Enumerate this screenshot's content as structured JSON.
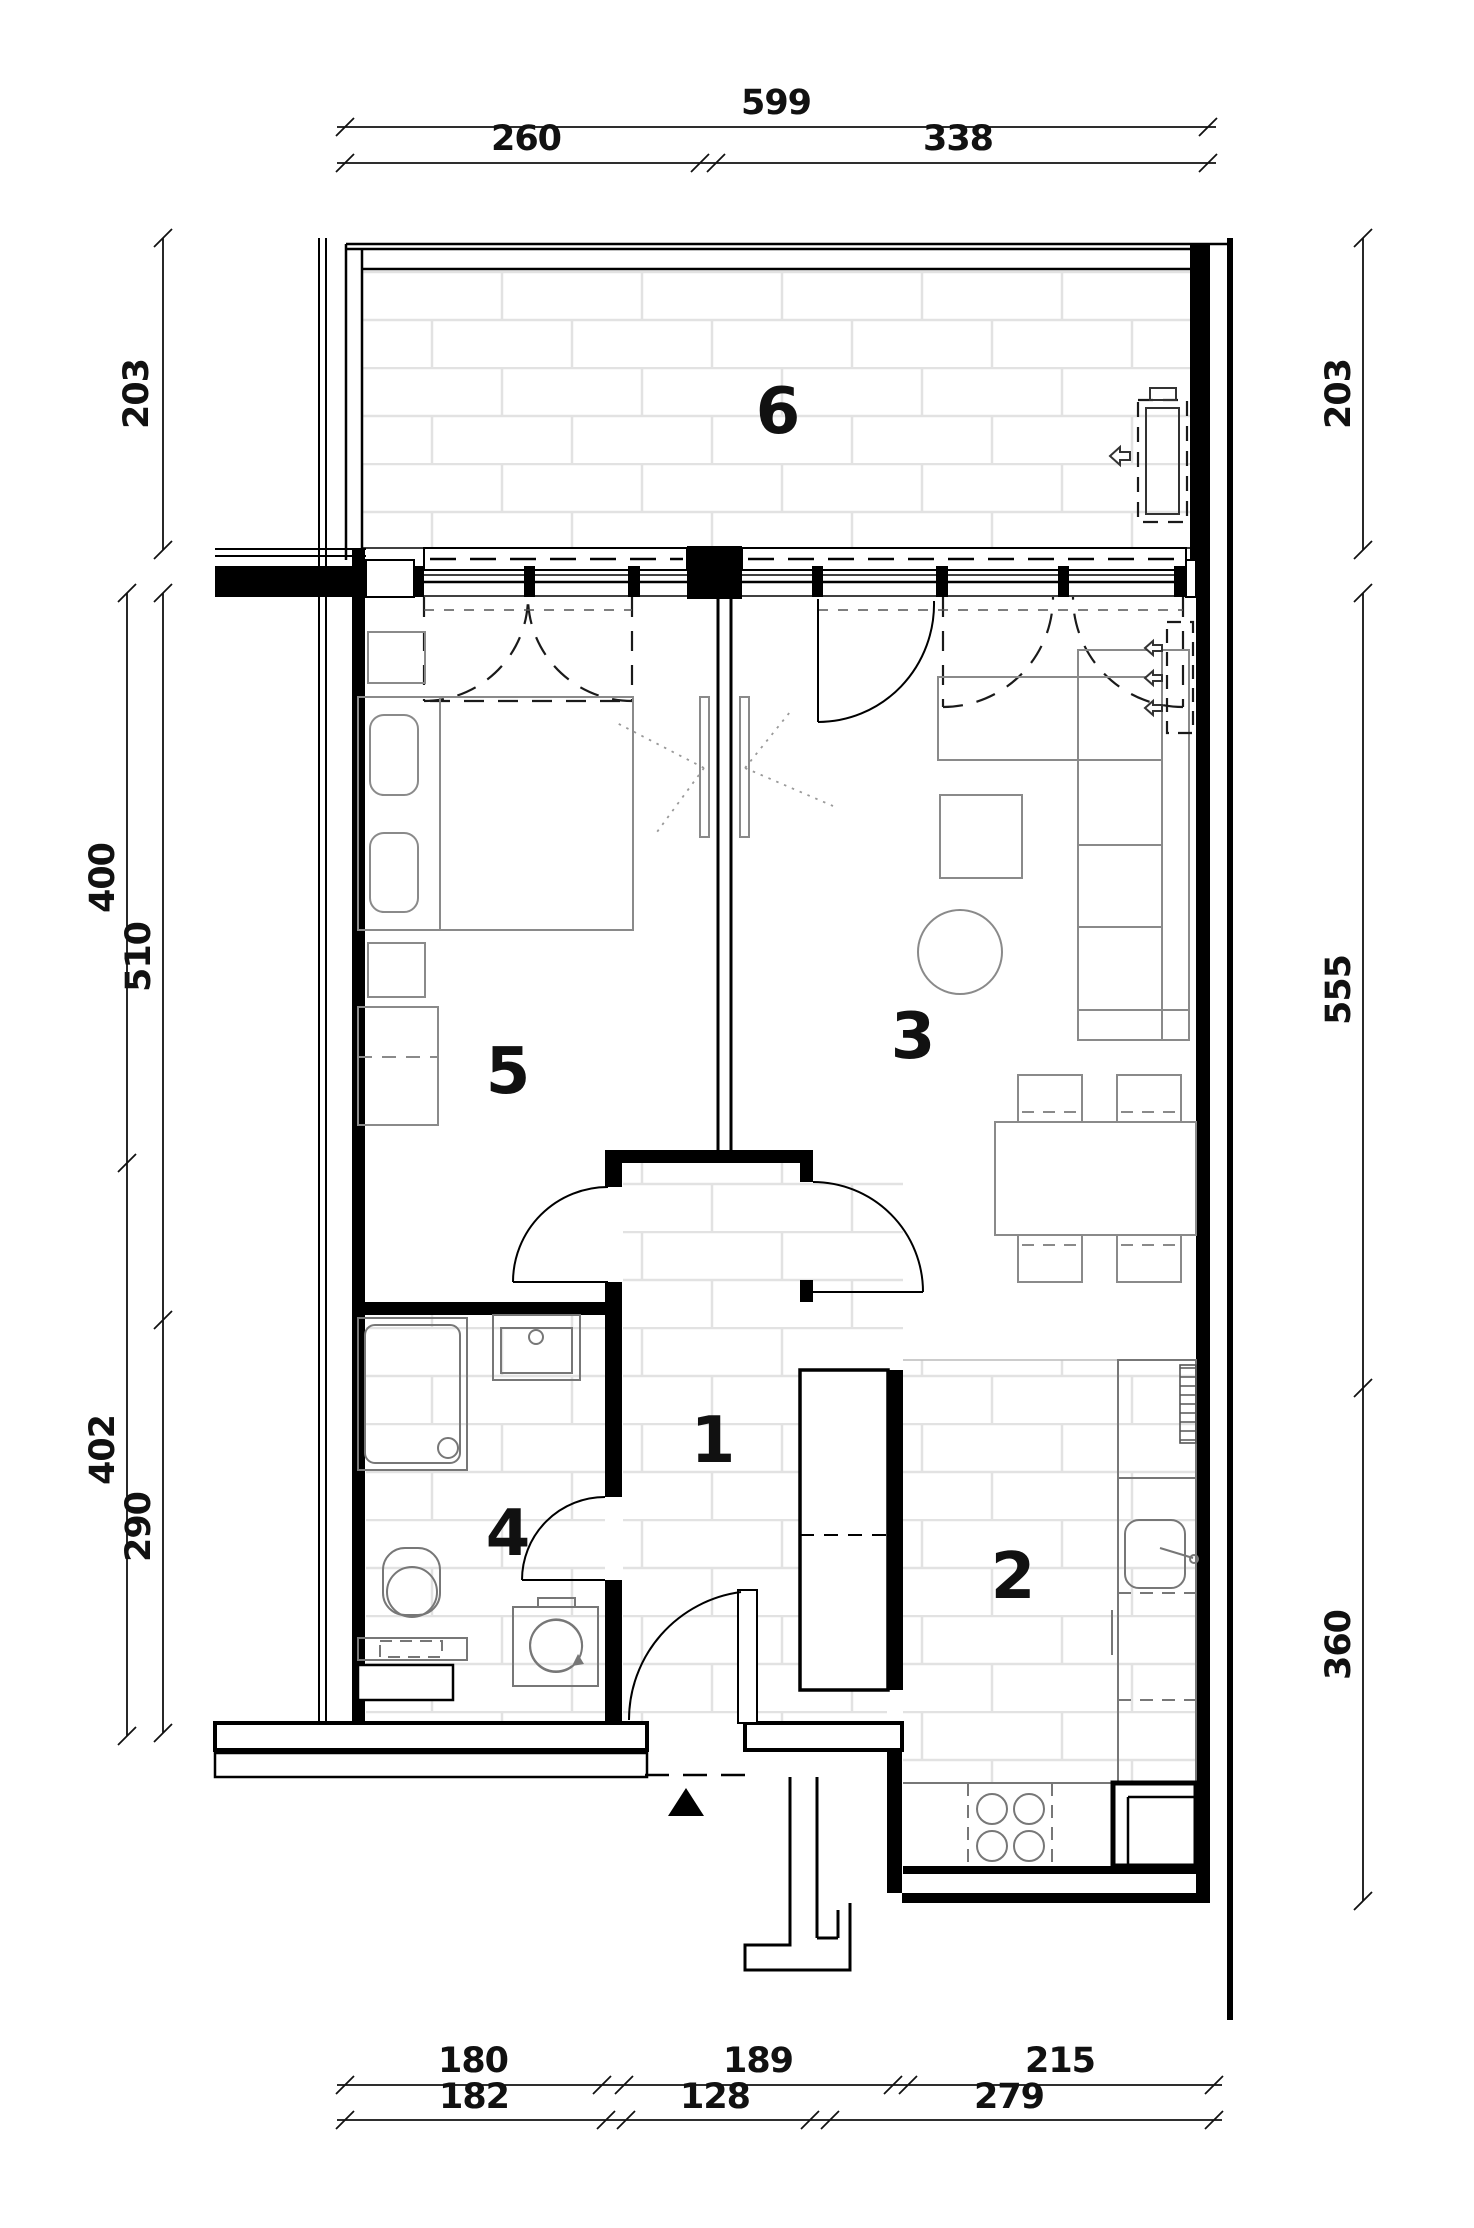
{
  "drawing_title": "apartment floor plan",
  "rooms": [
    {
      "id": "hallway",
      "label": "1"
    },
    {
      "id": "kitchen",
      "label": "2"
    },
    {
      "id": "living-room",
      "label": "3"
    },
    {
      "id": "bathroom",
      "label": "4"
    },
    {
      "id": "bedroom",
      "label": "5"
    },
    {
      "id": "balcony",
      "label": "6"
    }
  ],
  "dimensions": {
    "top": {
      "total": "599",
      "a": "260",
      "b": "338"
    },
    "left": {
      "balcony_depth": "203",
      "room_depth": "400",
      "room_depth2": "510",
      "lower_depth": "402",
      "bath_depth": "290"
    },
    "right": {
      "balcony_depth": "203",
      "living_depth": "555",
      "kitchen_depth": "360"
    },
    "bottom_row1": {
      "a": "180",
      "b": "189",
      "c": "215"
    },
    "bottom_row2": {
      "a": "182",
      "b": "128",
      "c": "279"
    }
  },
  "colors": {
    "walls": "#000000",
    "furniture": "#8a8a8a",
    "tile_joint": "#e2e2e2",
    "dimension_text": "#111111"
  },
  "icons": {
    "entry_marker": "solid triangle pointing up at entrance",
    "airflow_arrows": "hollow arrows pointing left",
    "washer_swirl": "rotation arrow inside washing machine"
  }
}
